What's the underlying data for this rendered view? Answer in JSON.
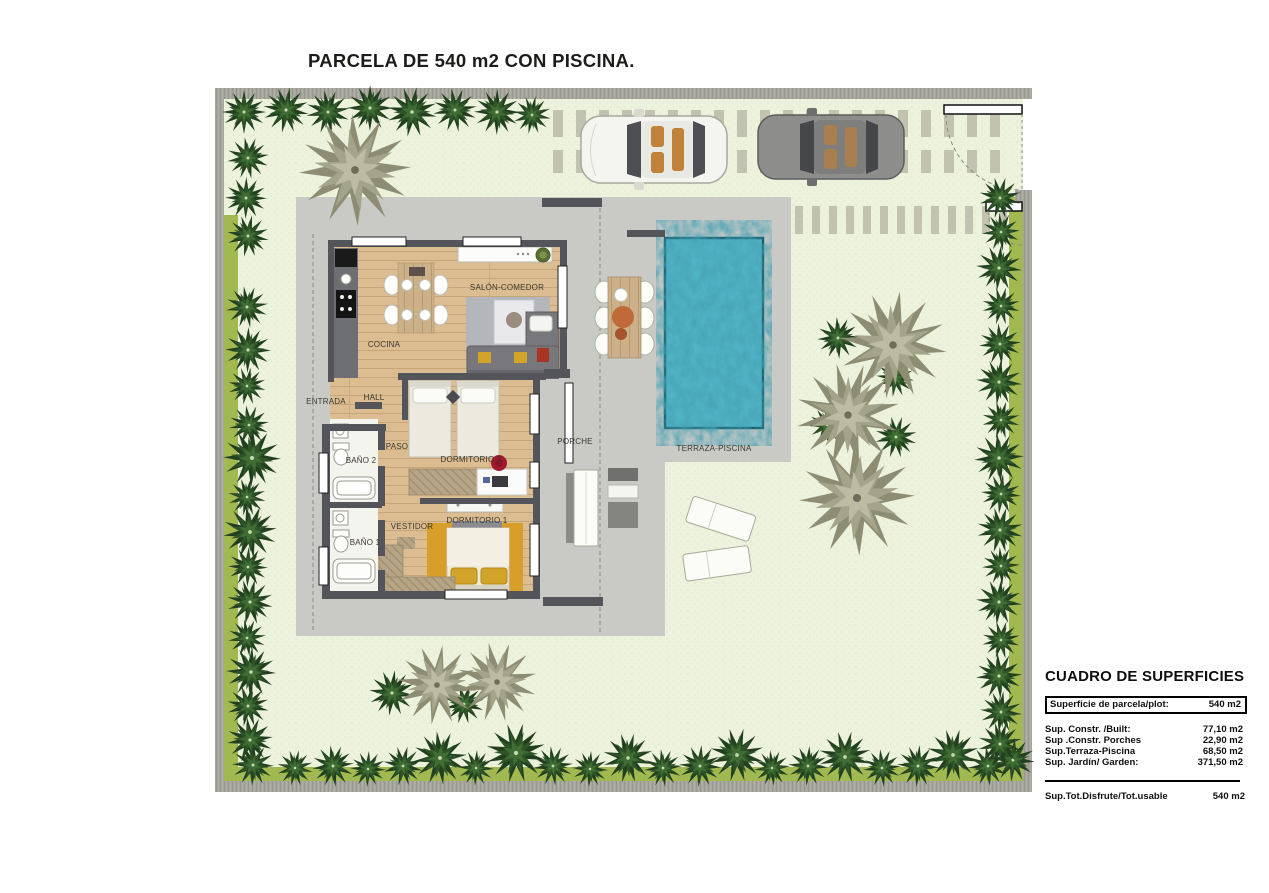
{
  "title": "PARCELA DE 540 m2 CON PISCINA.",
  "rooms": {
    "salon": "SALÓN-COMEDOR",
    "cocina": "COCINA",
    "entrada": "ENTRADA",
    "hall": "HALL",
    "paso": "PASO",
    "bano2": "BAÑO 2",
    "dormitorio2": "DORMITORIO 2",
    "vestidor": "VESTIDOR",
    "bano1": "BAÑO 1",
    "dormitorio1": "DORMITORIO 1",
    "porche": "PORCHE",
    "terraza": "TERRAZA-PISCINA"
  },
  "summary": {
    "title": "CUADRO DE SUPERFICIES",
    "plot_row": {
      "label": "Superficie de parcela/plot:",
      "value": "540 m2"
    },
    "rows": [
      {
        "label": "Sup. Constr. /Built:",
        "value": "77,10 m2"
      },
      {
        "label": "Sup .Constr. Porches",
        "value": "22,90 m2"
      },
      {
        "label": "Sup.Terraza-Piscina",
        "value": "68,50 m2"
      },
      {
        "label": "Sup. Jardín/ Garden:",
        "value": "371,50 m2"
      }
    ],
    "total": {
      "label": "Sup.Tot.Disfrute/Tot.usable",
      "value": "540 m2"
    }
  },
  "colors": {
    "lawn": "#ecf2dc",
    "grass_strip": "#a2b851",
    "boundary_wall": "#a7a69e",
    "terrace": "#c9c9c6",
    "paver": "#c1c2b0",
    "pool_water": "#52b4c8",
    "pool_edge": "#17606f",
    "house_wall": "#54555a",
    "wood_floor": "#dcbd92",
    "ochre_rug": "#d79e2a",
    "tree_dark": [
      "#22401f",
      "#2e5427",
      "#3f6d33",
      "#c6d8b0"
    ],
    "tree_taupe": [
      "#8d8d74",
      "#a4a48a",
      "#bcbca2",
      "#6d6d58"
    ]
  }
}
